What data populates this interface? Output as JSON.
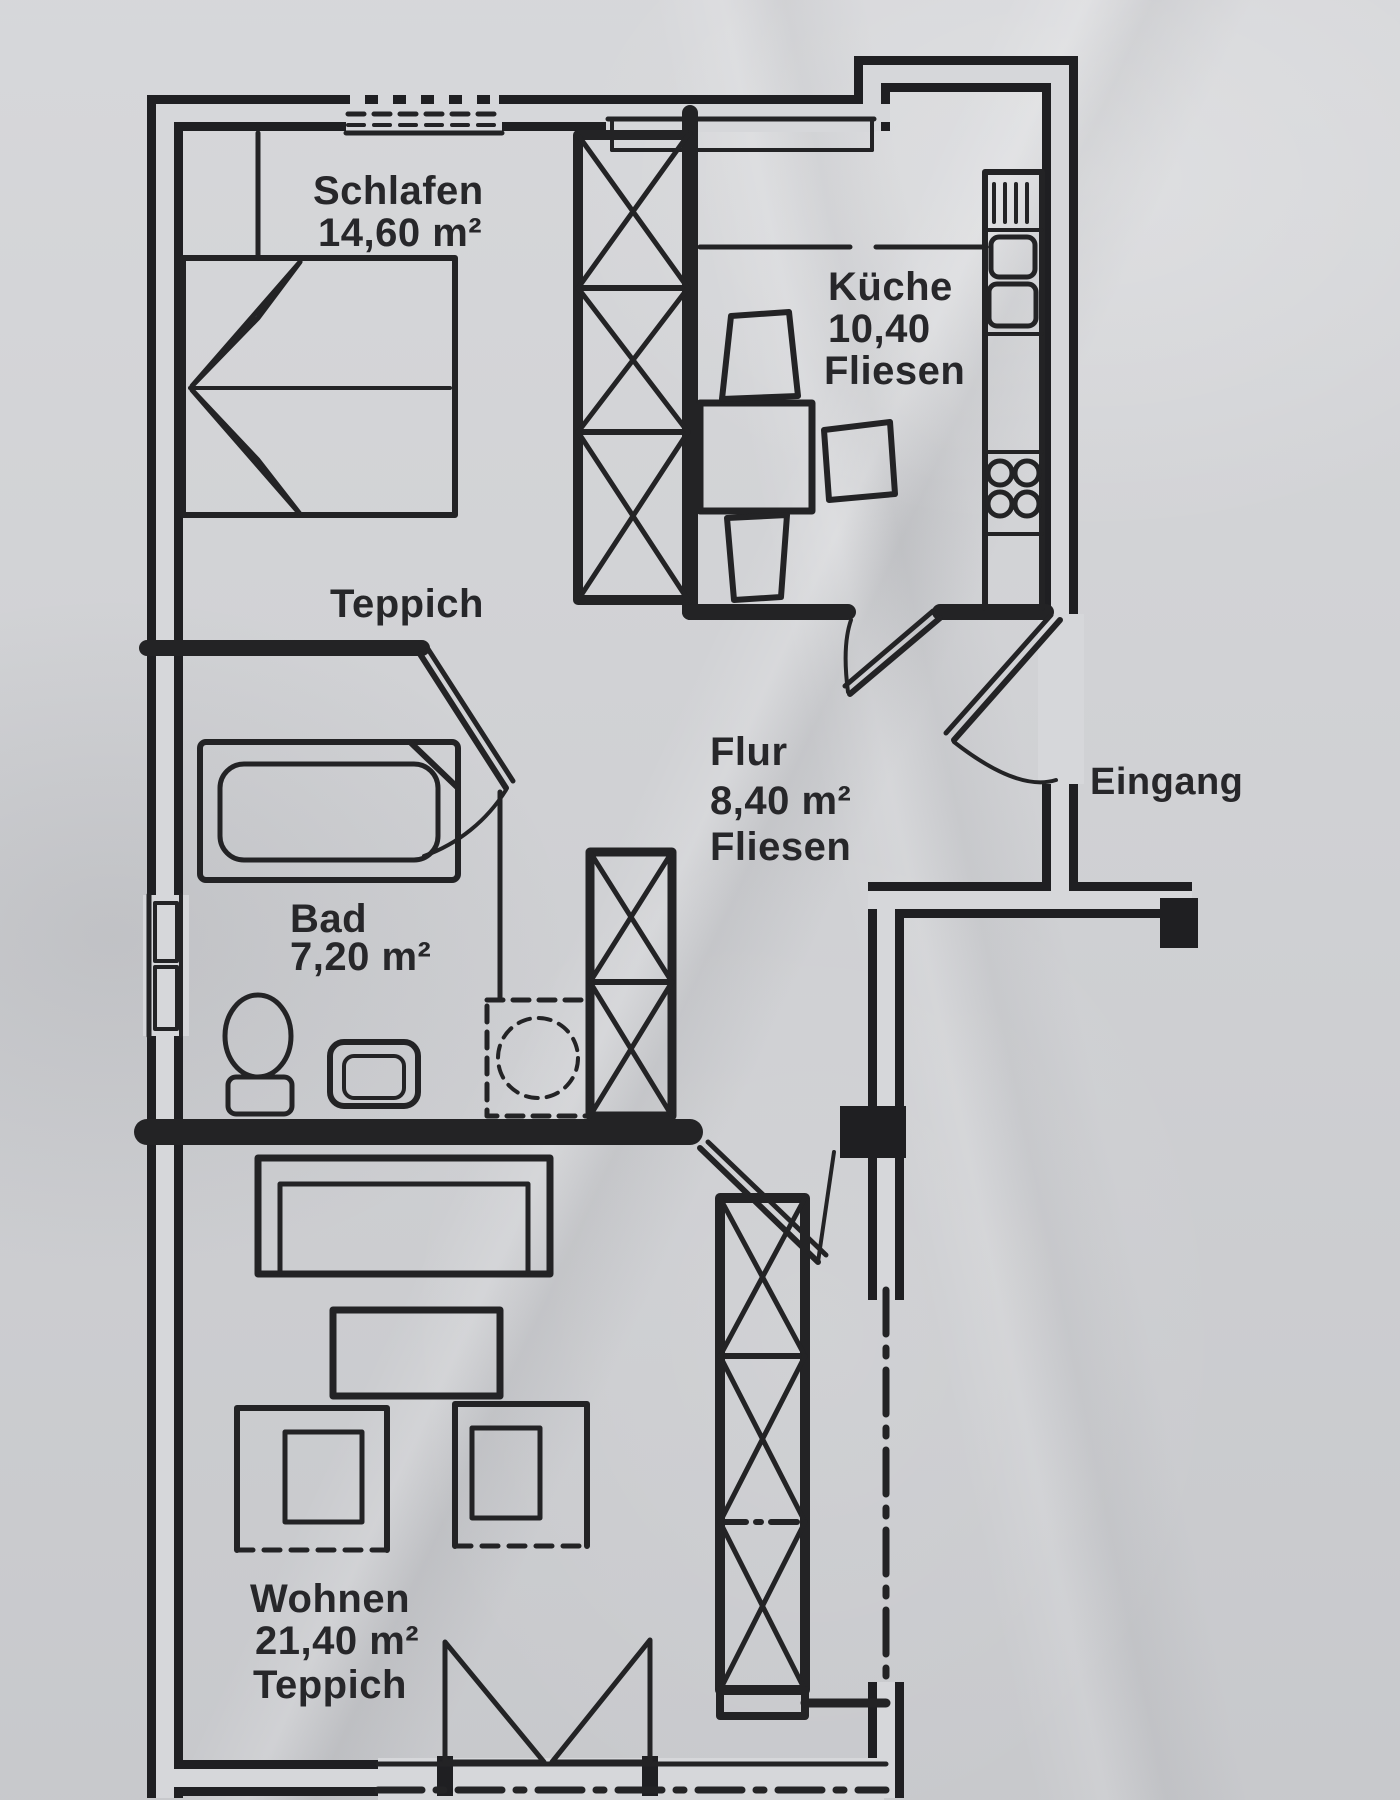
{
  "image": {
    "kind": "apartment floor plan printout, photographed",
    "language": "de"
  },
  "colors": {
    "paper": "#d2d3d6",
    "ink": "#202022"
  },
  "rooms": {
    "schlafen": {
      "name": "Schlafen",
      "area": "14,60 m²",
      "floor": "Teppich"
    },
    "kueche": {
      "name": "Küche",
      "area": "10,40",
      "floor": "Fliesen"
    },
    "flur": {
      "name": "Flur",
      "area": "8,40 m²",
      "floor": "Fliesen"
    },
    "bad": {
      "name": "Bad",
      "area": "7,20 m²"
    },
    "wohnen": {
      "name": "Wohnen",
      "area": "21,40 m²",
      "floor": "Teppich"
    }
  },
  "entrance": {
    "label": "Eingang"
  },
  "furniture": {
    "schlafen": [
      "double-bed",
      "built-in-wardrobe"
    ],
    "kueche": [
      "dining-table",
      "three-chairs",
      "kitchen-counter",
      "sink",
      "cooktop"
    ],
    "bad": [
      "bathtub",
      "toilet",
      "washbasin",
      "washing-machine"
    ],
    "flur": [
      "hall-wardrobe"
    ],
    "wohnen": [
      "sofa",
      "coffee-table",
      "two-armchairs",
      "tall-wardrobe",
      "balcony-double-door"
    ]
  },
  "openings": [
    "bedroom-window",
    "kitchen-window",
    "bathroom-window",
    "living-room-window-band",
    "balcony-door",
    "entrance-door",
    "kitchen-door",
    "bathroom-door",
    "living-room-door"
  ]
}
